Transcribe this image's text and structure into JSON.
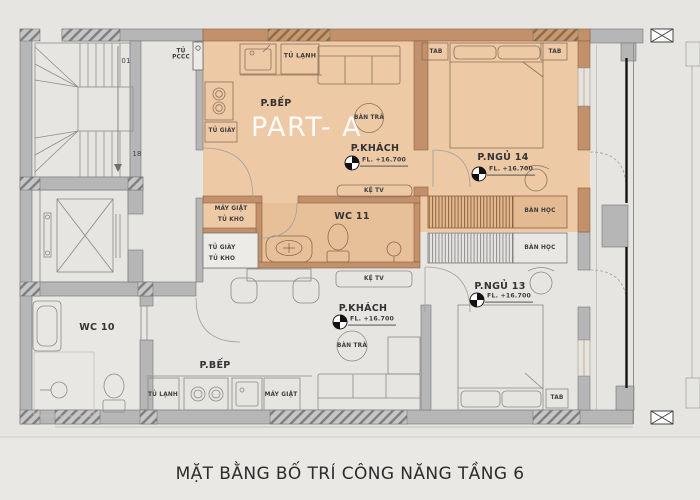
{
  "title": "MẶT BẰNG BỐ TRÍ CÔNG NĂNG TẦNG 6",
  "watermark": "PART- A",
  "colors": {
    "background": "#e7e5e2",
    "part_a_highlight": "#edc9a6",
    "wc11_floor": "#e7bf99",
    "wall_gray": "#b6b6b6",
    "wall_brown": "#c2916c",
    "railing_black": "#161616"
  },
  "core": {
    "fire_cabinet": "TỦ PCCC",
    "stair_step_first": "01",
    "stair_step_last": "18",
    "wc": "WC 10"
  },
  "apartment_a": {
    "kitchen": "P.BẾP",
    "fridge": "TỦ LẠNH",
    "shoe_cabinet": "TỦ GIÀY",
    "washing_machine": "MÁY GIẶT",
    "storage": "TỦ KHO",
    "wc": "WC 11",
    "living_room": "P.KHÁCH",
    "living_level": "FL. +16.700",
    "tea_table": "BÀN TRÀ",
    "tv_shelf": "KỆ TV",
    "bedroom": "P.NGỦ 14",
    "bedroom_level": "FL. +16.700",
    "nightstand_left": "TAB",
    "nightstand_right": "TAB",
    "desk": "BÀN HỌC"
  },
  "apartment_b": {
    "kitchen": "P.BẾP",
    "fridge": "TỦ LẠNH",
    "shoe_cabinet": "TỦ GIÀY",
    "storage": "TỦ KHO",
    "washing_machine": "MÁY GIẶT",
    "living_room": "P.KHÁCH",
    "living_level": "FL. +16.700",
    "tea_table": "BÀN TRÀ",
    "tv_shelf": "KỆ TV",
    "bedroom": "P.NGỦ 13",
    "bedroom_level": "FL. +16.700",
    "nightstand": "TAB",
    "desk": "BÀN HỌC"
  }
}
